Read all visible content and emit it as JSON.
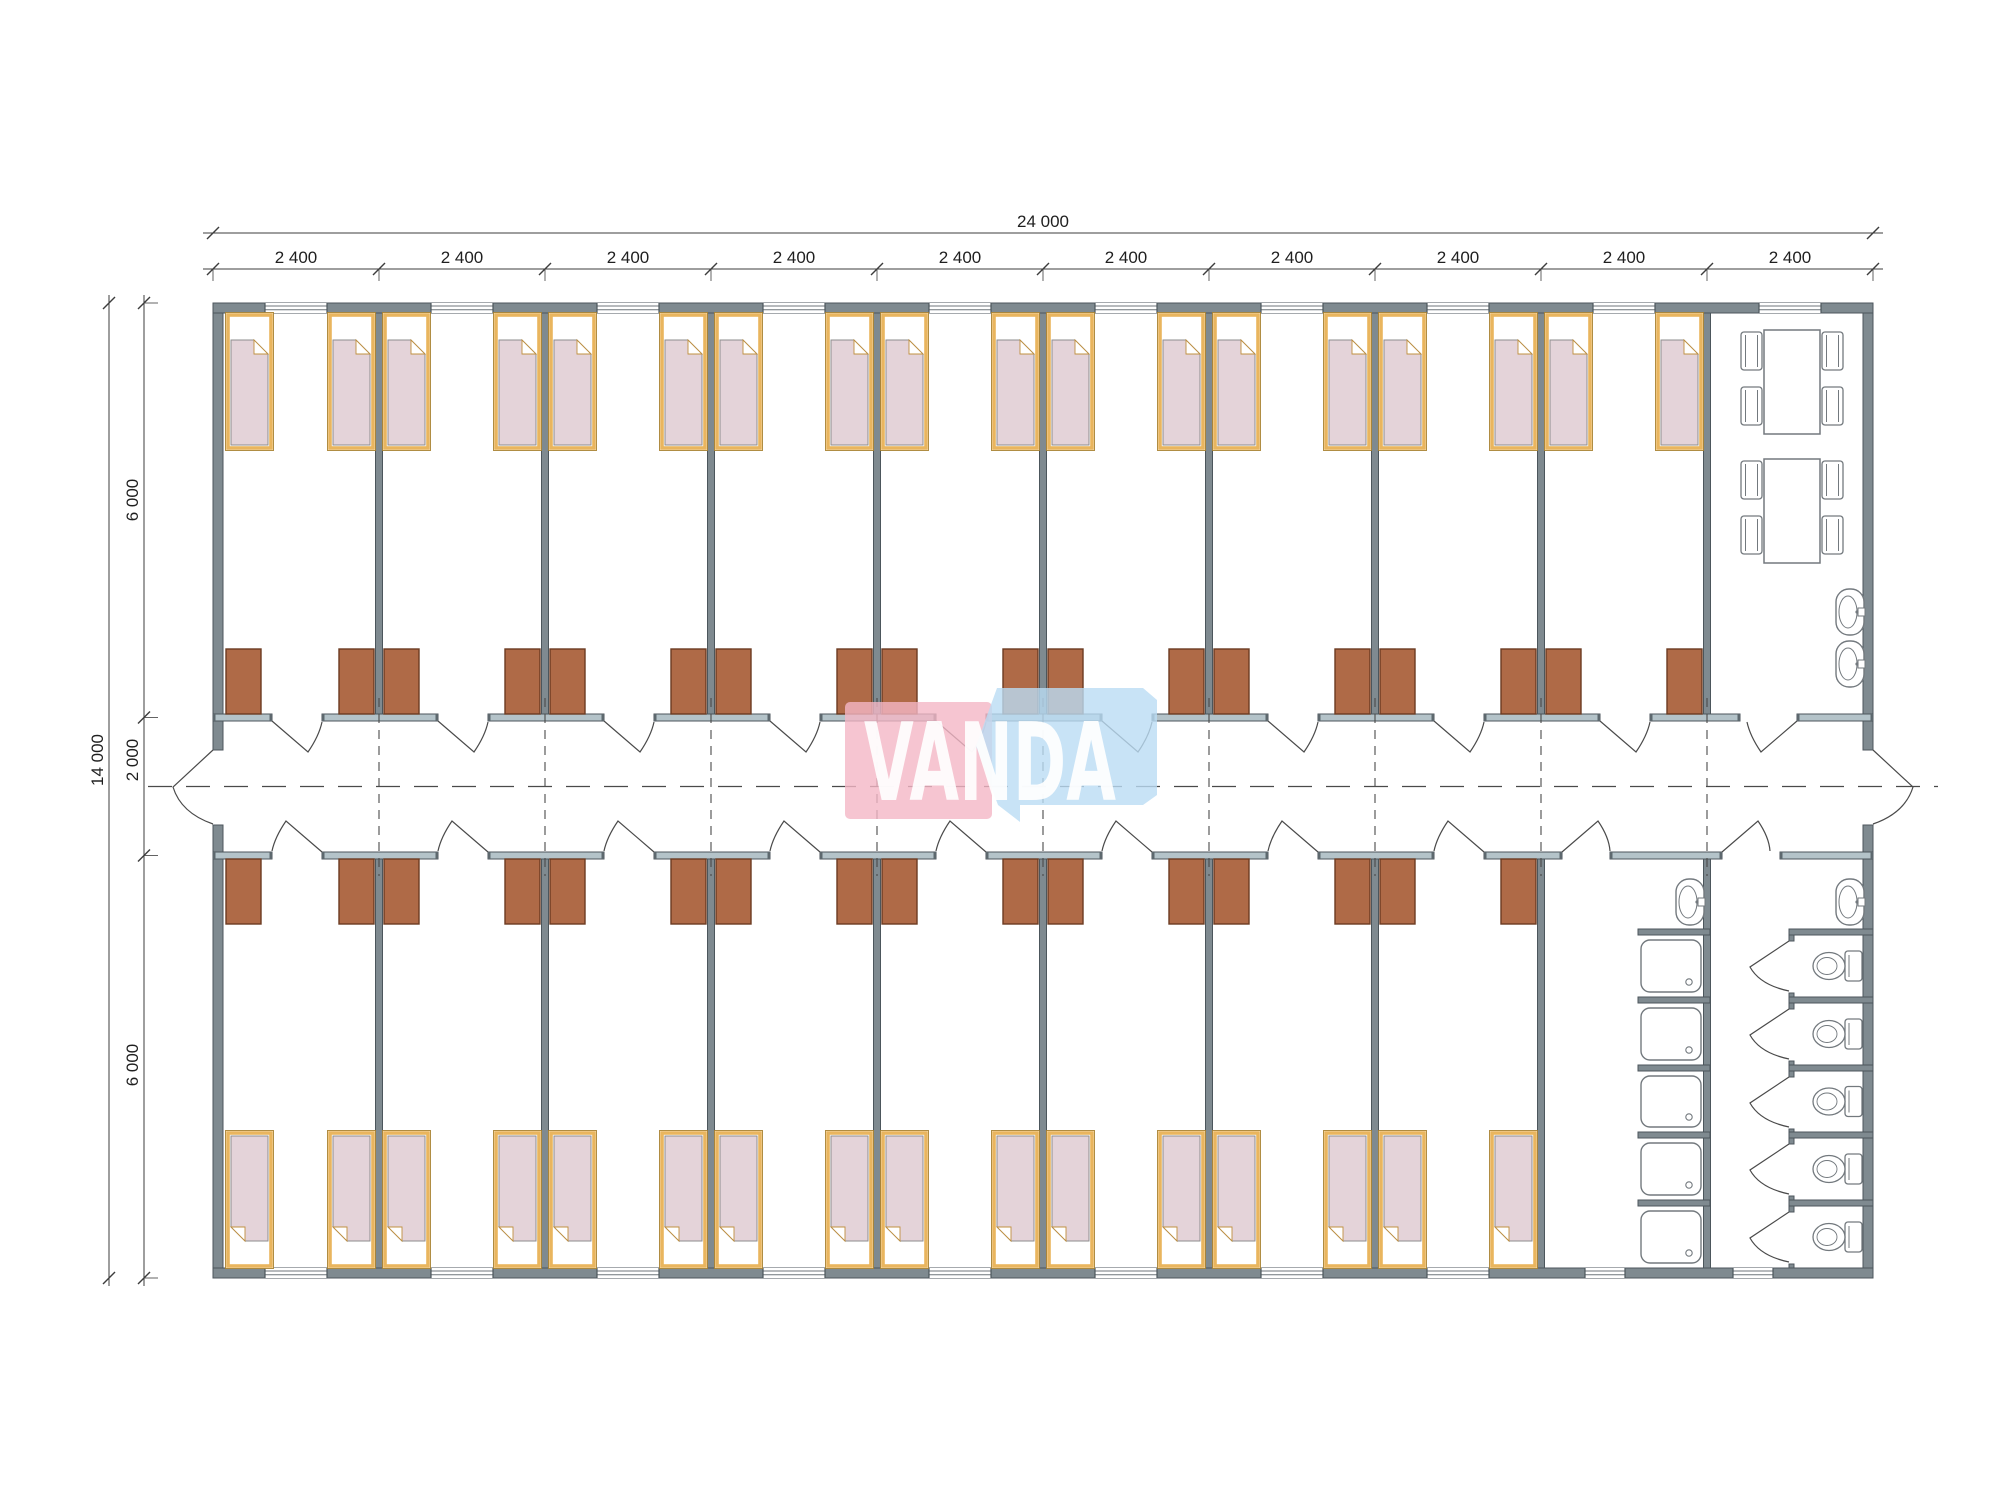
{
  "drawing": {
    "type": "floor-plan",
    "dimensions": {
      "total_width": "24 000",
      "width_segments": [
        "2 400",
        "2 400",
        "2 400",
        "2 400",
        "2 400",
        "2 400",
        "2 400",
        "2 400",
        "2 400",
        "2 400"
      ],
      "total_height": "14 000",
      "height_segments": [
        "6 000",
        "2 000",
        "6 000"
      ]
    },
    "logo": {
      "text": "VANDA",
      "pink": "#f4b7c6",
      "blue": "#badcf4",
      "text_color": "#ffffff"
    },
    "colors": {
      "wall": "#7f8a90",
      "wall_dark": "#4c565c",
      "wall_light": "#b4c3c9",
      "dim_line": "#3d3d3d",
      "door_line": "#4a4a4a",
      "fixture_line": "#73797e",
      "bed_frame": "#e9b55e",
      "bed_frame_edge": "#a8812f",
      "bed_blanket": "#e4d3d9",
      "blanket_edge": "#8e8e8e",
      "wardrobe": "#af6a47",
      "wardrobe_edge": "#6b3b22",
      "dash_line": "#4a4a4a"
    },
    "counts": {
      "modules": 10,
      "beds_top_row": 18,
      "beds_bottom_row": 16,
      "wardrobes_top_row": 18,
      "wardrobes_bottom_row": 16,
      "dining_tables": 2,
      "chairs_per_table": 4,
      "showers": 5,
      "toilets": 5,
      "washbasins": 4
    }
  }
}
